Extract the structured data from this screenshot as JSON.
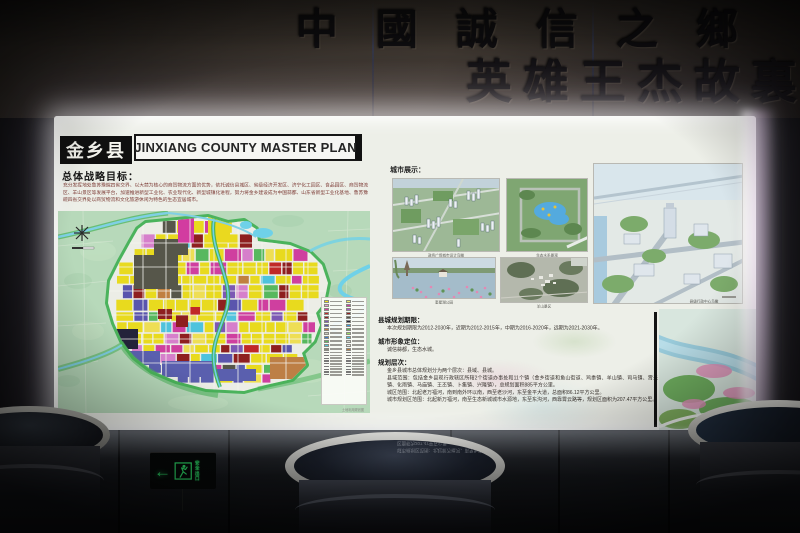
{
  "wall": {
    "calligraphy_line1": "中國誠信之鄉",
    "calligraphy_line2": "英雄王杰故裏"
  },
  "poster": {
    "title_cn": "金乡县",
    "title_en": "JINXIANG COUNTY  MASTER PLAN",
    "strategy_heading": "总体战略目标：",
    "strategy_body": "充分发挥地处鲁苏豫皖四省交界、以大蒜为核心的商贸物流方面的优势，依托诚信县城区、省级经济开发区、济宁化工园区、食品园区、商贸物流区、羊山景区等发展平台，加速推进新型工业化、农业现代化、新型城镇化进程，努力将金乡建设成为中国蒜都、山东省新型工业化基地、鲁苏豫皖四省交界处以商贸物流和文化旅游休闲为特色的生态宜居城市。",
    "map_caption": "土地利用规划图",
    "display_heading": "城市展示：",
    "captions": [
      "政务广场城市设计鸟瞰",
      "生态水系景观",
      "县级行政中心鸟瞰",
      "奎星湖公园",
      "羊山景区"
    ],
    "sections": [
      {
        "heading": "县城规划期限：",
        "lines": [
          "本次规划期限为2012-2030年，近期为2012-2015年，中期为2016-2020年，远期为2021-2030年。"
        ]
      },
      {
        "heading": "城市形象定位：",
        "lines": [
          "诚信蒜都，生态水城。"
        ]
      },
      {
        "heading": "规划层次：",
        "lines": [
          "金乡县城市总体规划分为两个层次：县域、县城。",
          "县域范围：包括金乡县现行政辖区所辖2个街道办事处和11个镇（金乡街道和鱼山街道、鸡黍镇、羊山镇、司马镇、霄云镇、化雨镇、马庙镇、王丕镇、卜集镇、兴隆镇），总规划面积885平方公里。",
          "城区范围：北起老万福河，南到南外环以南，西至老沙河，东至金平大道，总面积86.12平方公里。",
          "城市规划区范围：北起新万福河，南至生态新城城市水源地，东至东沟河，西靠霄云路等，规划区面积为207.47平方公里。"
        ]
      }
    ],
    "legend_col1": [
      "#f2e41c",
      "#e89ccd",
      "#d23ca0",
      "#c02828",
      "#8e1f1f",
      "#7c58b4",
      "#5a55ad",
      "#c08040",
      "#c8c8c0",
      "#3a78c8",
      "#57b85e",
      "#4fc3dd",
      "#8a8a80"
    ],
    "legend_col2": [
      "#f5ee6a",
      "#d23ca0",
      "#b05ccc",
      "#8e1f1f",
      "#56564a",
      "#23233a",
      "#3a9ad8",
      "#57b85e",
      "#9adf60",
      "#4fc3dd",
      "#d8d8d0",
      "#e8e8e8",
      "#b5793f"
    ]
  },
  "exit_sign": {
    "line1": "安全",
    "line2": "出口"
  },
  "colors": {
    "lightbox_glow": "#ffffff",
    "exit_green": "#2ee06a",
    "map_yellow": "#e8da1e",
    "map_magenta": "#cf3f9f",
    "map_greenbelt": "#3fae52",
    "map_water": "#6fd1e8"
  }
}
